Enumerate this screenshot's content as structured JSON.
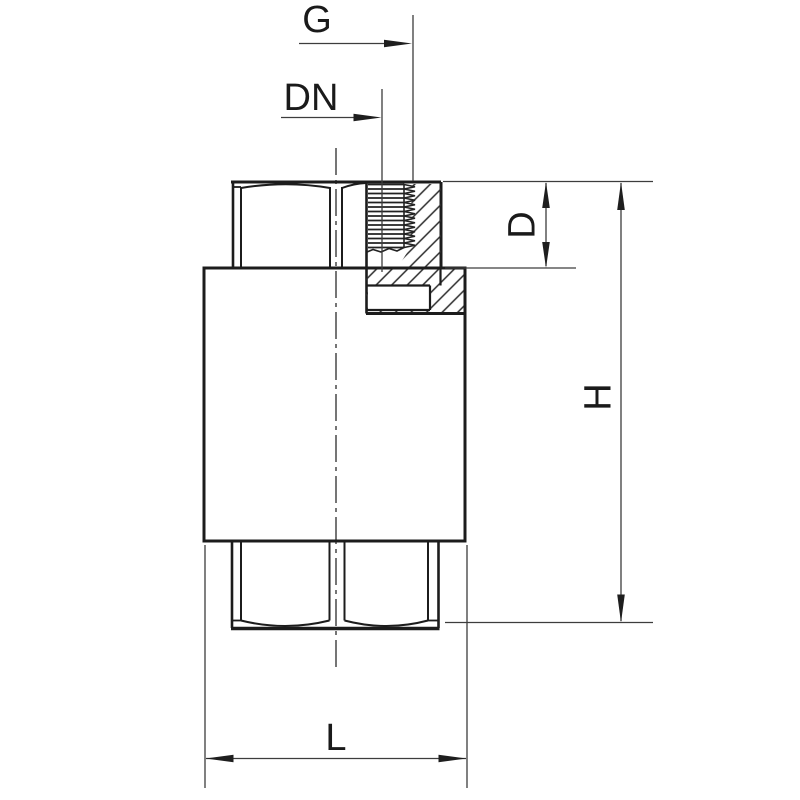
{
  "drawing": {
    "labels": {
      "g": "G",
      "dn": "DN",
      "d": "D",
      "h": "H",
      "l": "L"
    },
    "colors": {
      "background": "#ffffff",
      "object_line": "#1c1c1c",
      "dimension_line": "#3d3d3d",
      "text": "#1a1a1a"
    }
  }
}
